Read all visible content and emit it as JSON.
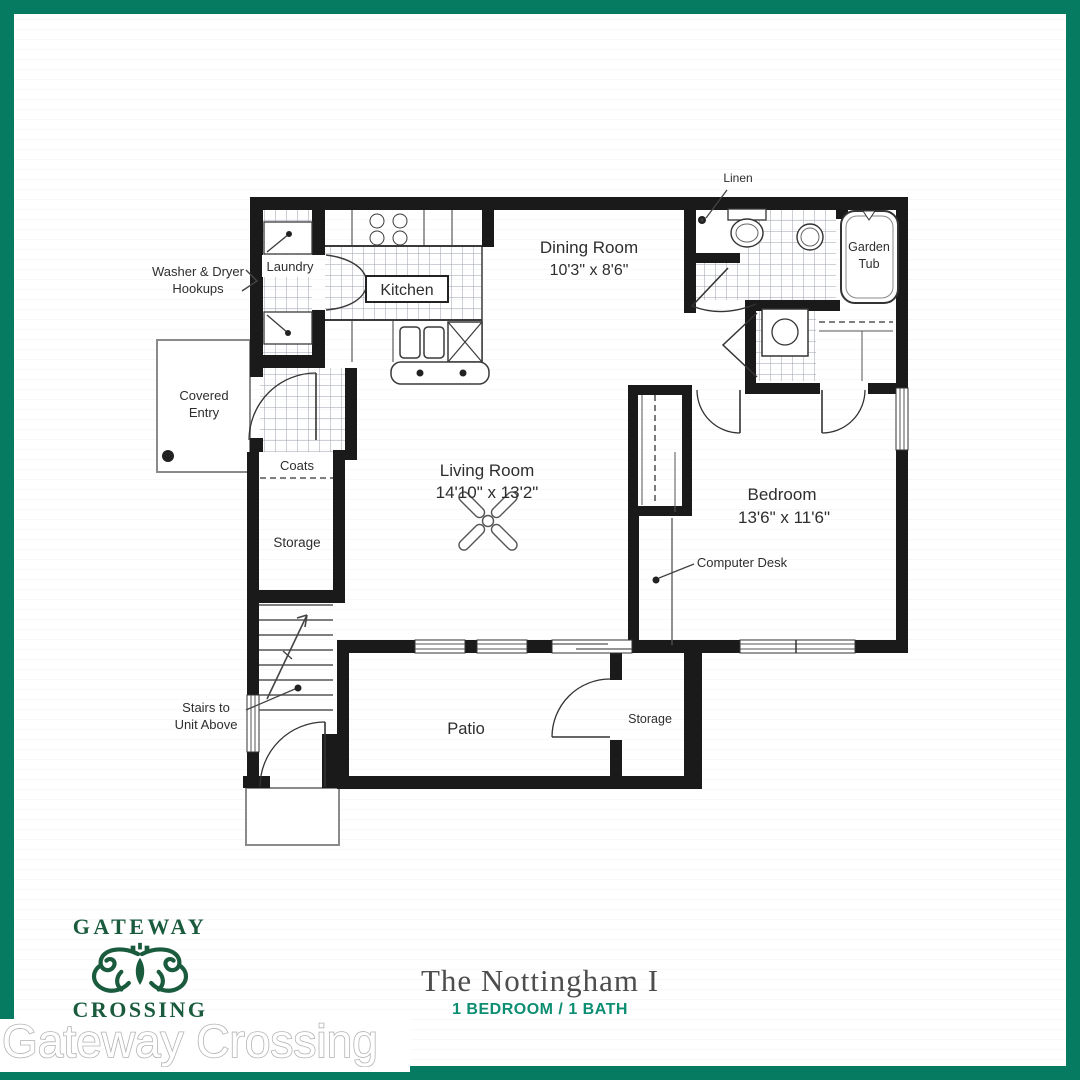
{
  "border_color": "#077a62",
  "floor_plan": {
    "labels": {
      "washer_dryer_line1": "Washer & Dryer",
      "washer_dryer_line2": "Hookups",
      "laundry": "Laundry",
      "kitchen": "Kitchen",
      "dining_name": "Dining Room",
      "dining_dims": "10'3\" x 8'6\"",
      "linen": "Linen",
      "garden_tub_line1": "Garden",
      "garden_tub_line2": "Tub",
      "covered_entry_line1": "Covered",
      "covered_entry_line2": "Entry",
      "coats": "Coats",
      "storage_closet": "Storage",
      "living_name": "Living Room",
      "living_dims": "14'10\" x 13'2\"",
      "bedroom_name": "Bedroom",
      "bedroom_dims": "13'6\" x 11'6\"",
      "computer_desk": "Computer Desk",
      "stairs_line1": "Stairs to",
      "stairs_line2": "Unit Above",
      "patio": "Patio",
      "storage_patio": "Storage"
    }
  },
  "branding": {
    "logo_top": "GATEWAY",
    "logo_bottom": "CROSSING",
    "logo_color": "#1a5b3e"
  },
  "footer": {
    "plan_name": "The Nottingham I",
    "plan_specs": "1 BEDROOM / 1 BATH",
    "specs_color": "#0d8e72"
  },
  "watermark": "Gateway Crossing"
}
